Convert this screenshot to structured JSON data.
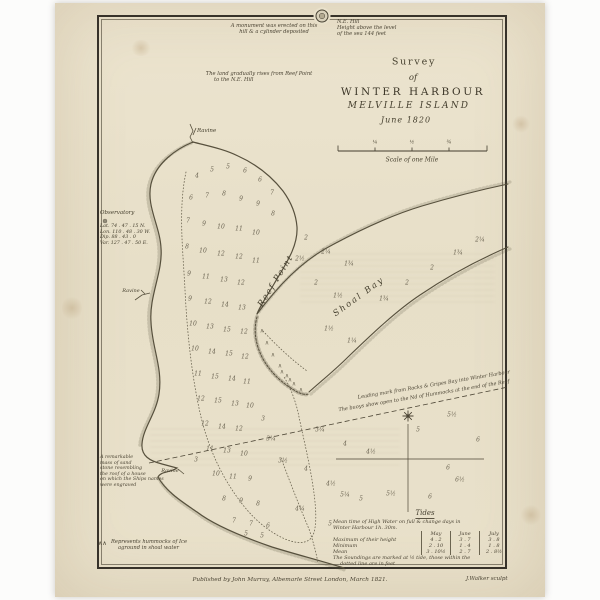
{
  "palette": {
    "paper": "#e9e1cb",
    "ink": "#453f30",
    "coast": "#57503d",
    "border": "#37322a"
  },
  "header_notes": {
    "monument": {
      "l1": "A monument was erected on this",
      "l2": "hill & a cylinder deposited"
    },
    "ne_hill": {
      "l1": "N.E. Hill",
      "l2": "Height above the level",
      "l3": "of the sea 144 feet"
    },
    "land_rise": {
      "l1": "The land gradually rises from Reef Point",
      "l2": "to the N.E. Hill"
    }
  },
  "title_block": {
    "survey": "Survey",
    "of": "of",
    "main": "WINTER HARBOUR",
    "sub": "MELVILLE ISLAND",
    "date": "June 1820"
  },
  "scale_bar": {
    "caption": "Scale of one Mile",
    "tick_labels": [
      "¼",
      "½",
      "¾"
    ]
  },
  "map_labels": {
    "ravine_top": "Ravine",
    "ravine_west": "Ravine",
    "ravine_south": "Ravine",
    "reef_point": "Reef Point",
    "shoal_bay": "Shoal Bay"
  },
  "observatory": {
    "title": "Observatory",
    "lines": [
      "Lat. 74 . 47 . 15 N.",
      "Lon. 110 . 48 . 30 W.",
      "Dip. 88 . 43 . 0",
      "Var. 127 . 47 . 50 E."
    ]
  },
  "sandstone_note": {
    "lines": [
      "A remarkable",
      "mass of sand",
      "stone resembling",
      "the roof of a house",
      "on which the Ships names",
      "were engraved"
    ]
  },
  "leading_marks": {
    "l1": "Leading mark from Rocks & Gripes Bay into Winter Harbour",
    "l2": "The buoys show open to the Nd of Hummocks at the end of the Reef"
  },
  "hummock_legend": {
    "symbol": "∧∧",
    "l1": "Represents hummocks of Ice",
    "l2": "aground in shoal water"
  },
  "tides": {
    "title": "Tides",
    "intro1": "Mean time of High Water on full & change days in",
    "intro2": "Winter Harbour 1h. 30m.",
    "columns": [
      "May",
      "June",
      "July"
    ],
    "rows": [
      {
        "label": "Maximum of their height",
        "values": [
          "4 . 2",
          "3 . 7",
          "3 . 8"
        ]
      },
      {
        "label": "Minimum",
        "values": [
          "2 . 10",
          "1 . 4",
          "1 . 8"
        ]
      },
      {
        "label": "Mean",
        "values": [
          "3 . 10½",
          "2 . 7",
          "2 . 8½"
        ]
      }
    ],
    "foot1": "The Soundings are marked at ½ tide, those within the",
    "foot2": "dotted line are in feet"
  },
  "imprint": {
    "publisher": "Published by John Murray, Albemarle Street London, March 1821.",
    "engraver": "J.Walker sculpt"
  },
  "hummock_symbol": "∧",
  "hummocks": [
    {
      "x": 262,
      "y": 331
    },
    {
      "x": 267,
      "y": 343
    },
    {
      "x": 273,
      "y": 355
    },
    {
      "x": 280,
      "y": 366
    },
    {
      "x": 287,
      "y": 376
    },
    {
      "x": 294,
      "y": 384
    },
    {
      "x": 301,
      "y": 390
    },
    {
      "x": 282,
      "y": 372
    },
    {
      "x": 290,
      "y": 380
    }
  ],
  "soundings": [
    {
      "x": 197,
      "y": 176,
      "v": "4"
    },
    {
      "x": 212,
      "y": 170,
      "v": "5"
    },
    {
      "x": 228,
      "y": 167,
      "v": "5"
    },
    {
      "x": 245,
      "y": 171,
      "v": "6"
    },
    {
      "x": 260,
      "y": 180,
      "v": "6"
    },
    {
      "x": 272,
      "y": 193,
      "v": "7"
    },
    {
      "x": 191,
      "y": 198,
      "v": "6"
    },
    {
      "x": 207,
      "y": 196,
      "v": "7"
    },
    {
      "x": 224,
      "y": 194,
      "v": "8"
    },
    {
      "x": 241,
      "y": 199,
      "v": "9"
    },
    {
      "x": 258,
      "y": 204,
      "v": "9"
    },
    {
      "x": 273,
      "y": 214,
      "v": "8"
    },
    {
      "x": 188,
      "y": 221,
      "v": "7"
    },
    {
      "x": 204,
      "y": 224,
      "v": "9"
    },
    {
      "x": 221,
      "y": 227,
      "v": "10"
    },
    {
      "x": 239,
      "y": 229,
      "v": "11"
    },
    {
      "x": 256,
      "y": 233,
      "v": "10"
    },
    {
      "x": 187,
      "y": 247,
      "v": "8"
    },
    {
      "x": 203,
      "y": 251,
      "v": "10"
    },
    {
      "x": 221,
      "y": 254,
      "v": "12"
    },
    {
      "x": 239,
      "y": 257,
      "v": "12"
    },
    {
      "x": 256,
      "y": 261,
      "v": "11"
    },
    {
      "x": 189,
      "y": 274,
      "v": "9"
    },
    {
      "x": 206,
      "y": 277,
      "v": "11"
    },
    {
      "x": 224,
      "y": 280,
      "v": "13"
    },
    {
      "x": 241,
      "y": 283,
      "v": "12"
    },
    {
      "x": 190,
      "y": 299,
      "v": "9"
    },
    {
      "x": 208,
      "y": 302,
      "v": "12"
    },
    {
      "x": 225,
      "y": 305,
      "v": "14"
    },
    {
      "x": 242,
      "y": 308,
      "v": "13"
    },
    {
      "x": 193,
      "y": 324,
      "v": "10"
    },
    {
      "x": 210,
      "y": 327,
      "v": "13"
    },
    {
      "x": 227,
      "y": 330,
      "v": "15"
    },
    {
      "x": 244,
      "y": 332,
      "v": "12"
    },
    {
      "x": 195,
      "y": 349,
      "v": "10"
    },
    {
      "x": 212,
      "y": 352,
      "v": "14"
    },
    {
      "x": 229,
      "y": 354,
      "v": "15"
    },
    {
      "x": 245,
      "y": 357,
      "v": "12"
    },
    {
      "x": 198,
      "y": 374,
      "v": "11"
    },
    {
      "x": 215,
      "y": 377,
      "v": "15"
    },
    {
      "x": 232,
      "y": 379,
      "v": "14"
    },
    {
      "x": 247,
      "y": 382,
      "v": "11"
    },
    {
      "x": 201,
      "y": 399,
      "v": "12"
    },
    {
      "x": 218,
      "y": 401,
      "v": "15"
    },
    {
      "x": 235,
      "y": 404,
      "v": "13"
    },
    {
      "x": 250,
      "y": 406,
      "v": "10"
    },
    {
      "x": 205,
      "y": 424,
      "v": "12"
    },
    {
      "x": 222,
      "y": 427,
      "v": "14"
    },
    {
      "x": 239,
      "y": 429,
      "v": "12"
    },
    {
      "x": 210,
      "y": 449,
      "v": "11"
    },
    {
      "x": 227,
      "y": 451,
      "v": "13"
    },
    {
      "x": 244,
      "y": 454,
      "v": "10"
    },
    {
      "x": 216,
      "y": 474,
      "v": "10"
    },
    {
      "x": 233,
      "y": 477,
      "v": "11"
    },
    {
      "x": 250,
      "y": 479,
      "v": "9"
    },
    {
      "x": 224,
      "y": 499,
      "v": "8"
    },
    {
      "x": 241,
      "y": 501,
      "v": "9"
    },
    {
      "x": 258,
      "y": 504,
      "v": "8"
    },
    {
      "x": 234,
      "y": 521,
      "v": "7"
    },
    {
      "x": 251,
      "y": 524,
      "v": "7"
    },
    {
      "x": 268,
      "y": 526,
      "v": "6"
    },
    {
      "x": 246,
      "y": 534,
      "v": "5"
    },
    {
      "x": 262,
      "y": 536,
      "v": "5"
    },
    {
      "x": 306,
      "y": 238,
      "v": "2"
    },
    {
      "x": 326,
      "y": 252,
      "v": "2¼"
    },
    {
      "x": 349,
      "y": 264,
      "v": "1¾"
    },
    {
      "x": 316,
      "y": 283,
      "v": "2"
    },
    {
      "x": 338,
      "y": 296,
      "v": "1½"
    },
    {
      "x": 384,
      "y": 299,
      "v": "1¾"
    },
    {
      "x": 407,
      "y": 283,
      "v": "2"
    },
    {
      "x": 329,
      "y": 329,
      "v": "1½"
    },
    {
      "x": 352,
      "y": 341,
      "v": "1¼"
    },
    {
      "x": 300,
      "y": 259,
      "v": "2½"
    },
    {
      "x": 432,
      "y": 268,
      "v": "2"
    },
    {
      "x": 458,
      "y": 253,
      "v": "1¾"
    },
    {
      "x": 480,
      "y": 240,
      "v": "2¼"
    },
    {
      "x": 320,
      "y": 430,
      "v": "3¾"
    },
    {
      "x": 345,
      "y": 444,
      "v": "4"
    },
    {
      "x": 371,
      "y": 452,
      "v": "4½"
    },
    {
      "x": 306,
      "y": 469,
      "v": "4"
    },
    {
      "x": 331,
      "y": 484,
      "v": "4½"
    },
    {
      "x": 361,
      "y": 499,
      "v": "5"
    },
    {
      "x": 391,
      "y": 494,
      "v": "5½"
    },
    {
      "x": 300,
      "y": 509,
      "v": "4¾"
    },
    {
      "x": 330,
      "y": 524,
      "v": "5"
    },
    {
      "x": 283,
      "y": 461,
      "v": "3½"
    },
    {
      "x": 271,
      "y": 439,
      "v": "3¼"
    },
    {
      "x": 263,
      "y": 419,
      "v": "3"
    },
    {
      "x": 345,
      "y": 495,
      "v": "5¼"
    },
    {
      "x": 448,
      "y": 468,
      "v": "6"
    },
    {
      "x": 418,
      "y": 430,
      "v": "5"
    },
    {
      "x": 452,
      "y": 415,
      "v": "5½"
    },
    {
      "x": 478,
      "y": 440,
      "v": "6"
    },
    {
      "x": 460,
      "y": 480,
      "v": "6½"
    },
    {
      "x": 430,
      "y": 497,
      "v": "6"
    },
    {
      "x": 196,
      "y": 460,
      "v": "3"
    }
  ]
}
